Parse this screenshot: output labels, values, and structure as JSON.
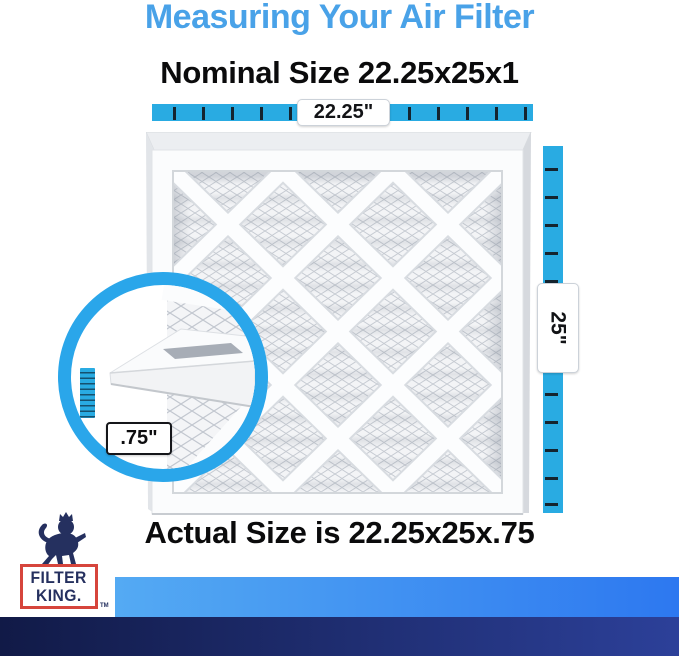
{
  "title": "Measuring Your Air Filter",
  "nominal_heading": "Nominal Size 22.25x25x1",
  "actual_heading": "Actual Size is 22.25x25x.75",
  "rulers": {
    "width_label": "22.25\"",
    "height_label": "25\"",
    "depth_label": ".75\""
  },
  "dimensions": {
    "nominal": "22.25x25x1",
    "actual_width": "22.25\"",
    "actual_height": "25\"",
    "actual_depth": ".75\""
  },
  "logo": {
    "line1": "FILTER",
    "line2": "KING.",
    "trademark": "TM"
  },
  "colors": {
    "title-blue": "#49a2e8",
    "ruler-blue": "#29abe2",
    "ring-blue": "#2aa6ea",
    "tick-dark": "#14242f",
    "text-dark": "#0b0b0c",
    "logo-navy": "#25305f",
    "logo-red": "#d6453c",
    "strip-light-left": "#54aaf3",
    "strip-light-right": "#2d78f0",
    "strip-navy-left": "#111a47",
    "strip-navy-right": "#2c4099"
  }
}
